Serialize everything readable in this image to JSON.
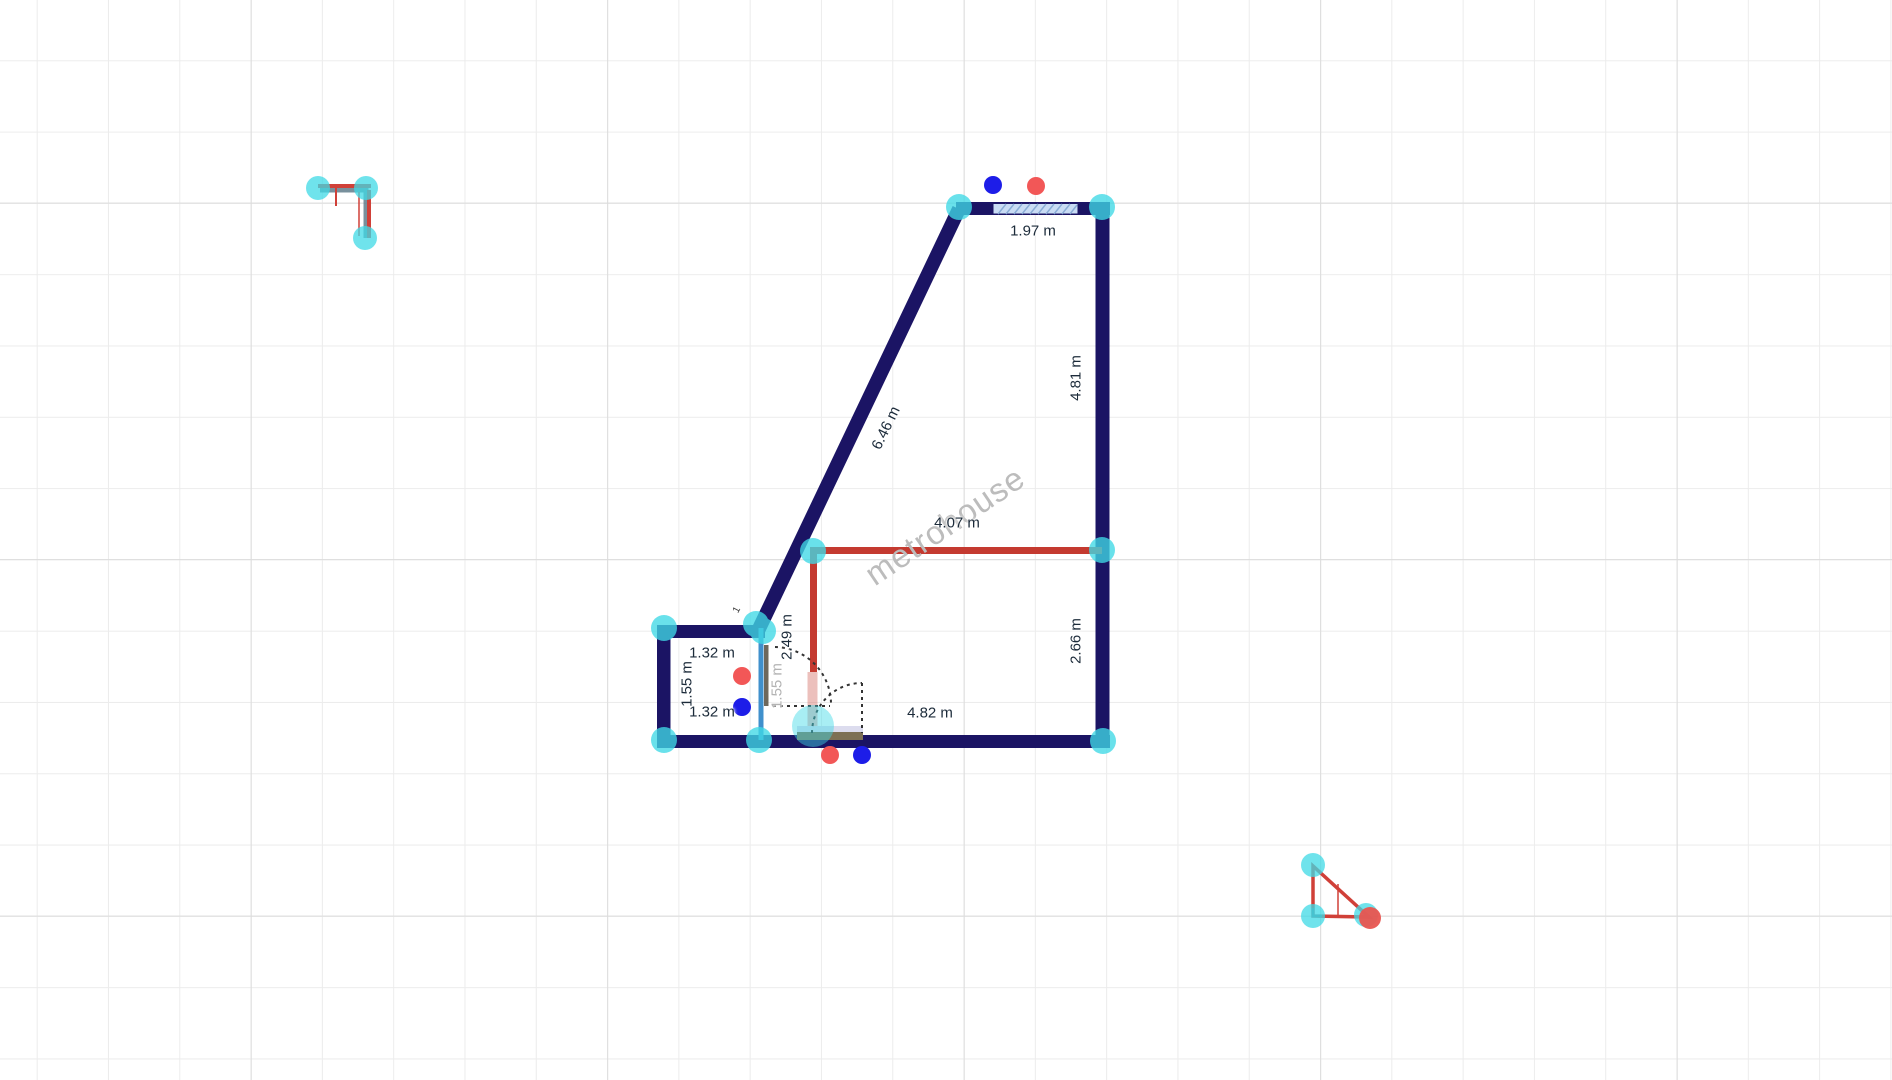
{
  "plan": {
    "watermark": "metrohouse",
    "dimension_labels": {
      "top_window": "1.97 m",
      "right_upper": "4.81 m",
      "diagonal_wall": "6.46 m",
      "interior_horizontal_wall": "4.07 m",
      "right_lower": "2.66 m",
      "bottom_wall": "4.82 m",
      "storage_room_top": "1.32 m",
      "storage_room_bottom": "1.32 m",
      "storage_room_left": "1.55 m",
      "interior_vertical_wall": "2.49 m",
      "partition_wall": "1.55 m",
      "mini_tick": "1"
    },
    "colors": {
      "exterior_wall": "#1b1464",
      "interior_wall_red": "#c43a30",
      "partition_wall_blue": "#4090cc",
      "selection_handle_cyan": "#3fd9e6",
      "node_dot_blue": "#1d1de8",
      "node_dot_red": "#f25757",
      "window_fill": "#c9dcf4",
      "window_hatch": "#8badd6",
      "door_threshold_brown": "#7d7055",
      "door_threshold_lavender": "#dcdcee",
      "grid_minor": "#ececec",
      "grid_major": "#dcdcdc",
      "watermark_gray": "#bcbcbc"
    }
  }
}
